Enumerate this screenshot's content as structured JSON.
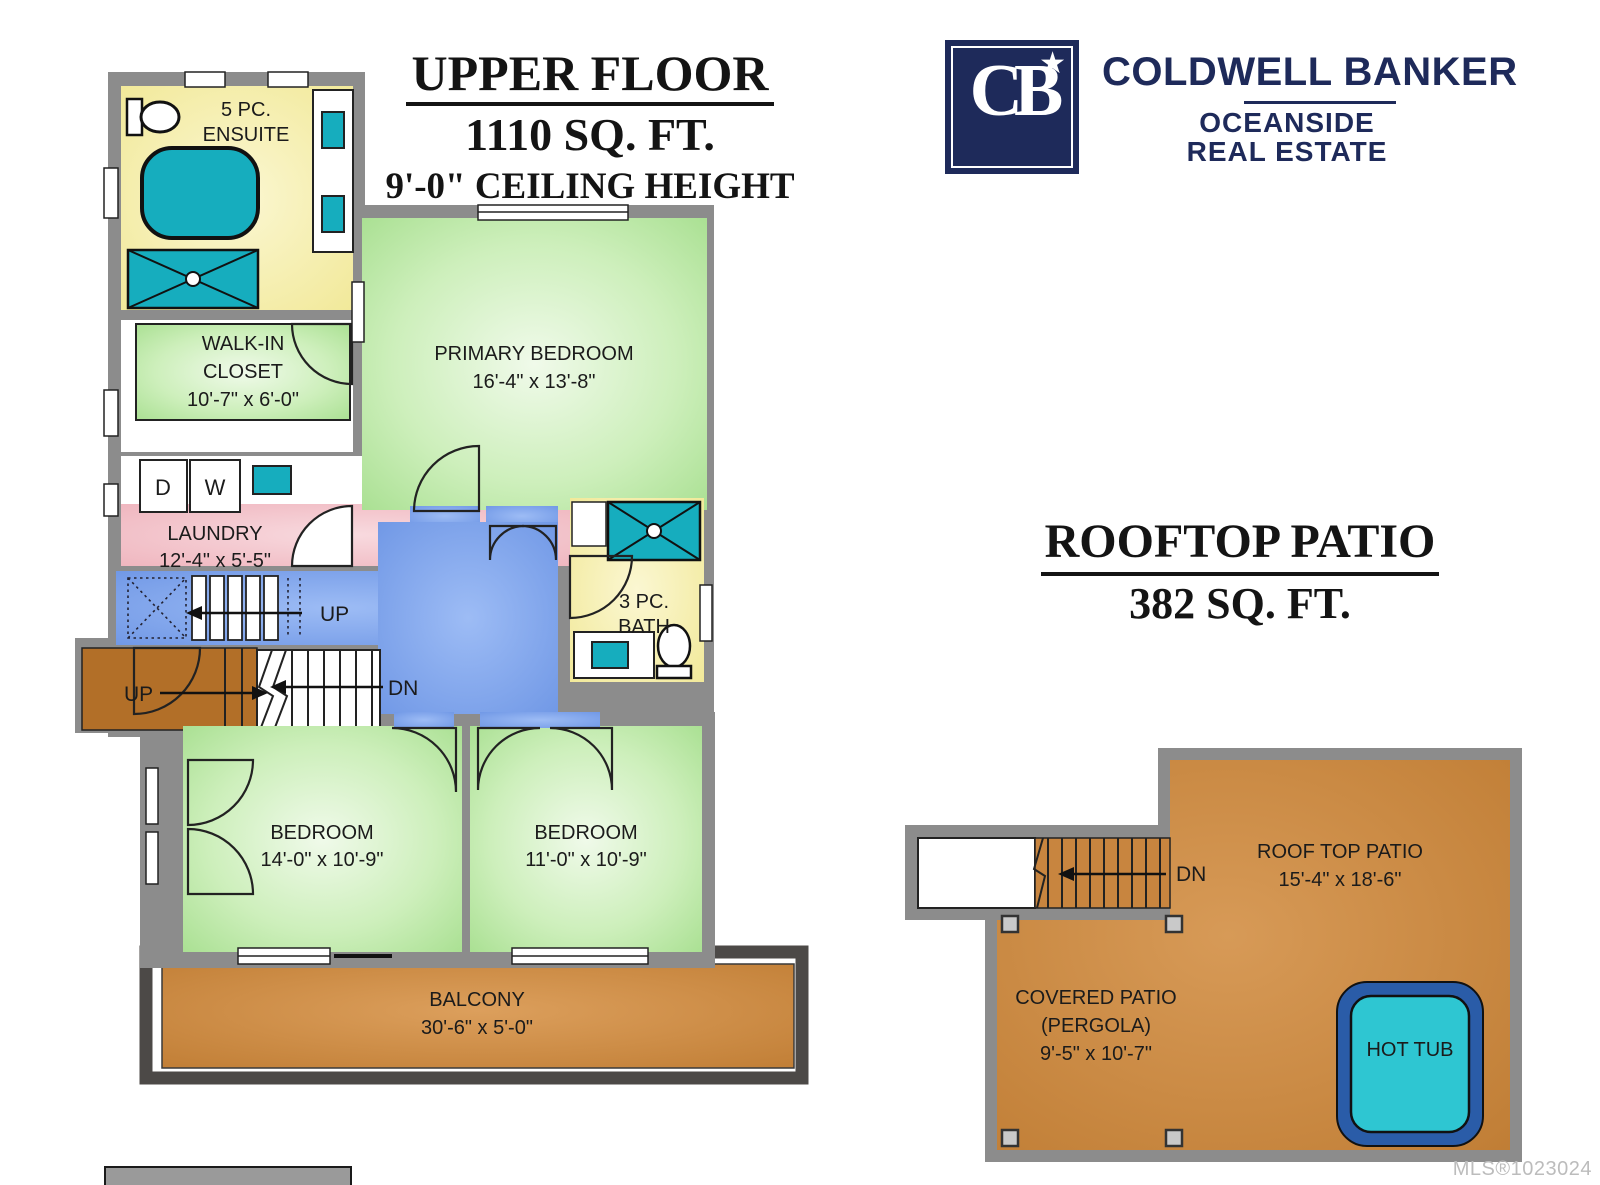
{
  "header": {
    "upper": {
      "title": "UPPER FLOOR",
      "area": "1110 SQ. FT.",
      "ceiling": "9'-0\" CEILING HEIGHT"
    },
    "brand": {
      "name": "COLDWELL BANKER",
      "sub1": "OCEANSIDE",
      "sub2": "REAL ESTATE",
      "monogram": "CB",
      "star": "★"
    }
  },
  "rooftop_header": {
    "title": "ROOFTOP PATIO",
    "area": "382 SQ. FT."
  },
  "rooms": {
    "ensuite": {
      "line1": "5 PC.",
      "line2": "ENSUITE"
    },
    "walkin": {
      "line1": "WALK-IN",
      "line2": "CLOSET",
      "dim": "10'-7\" x 6'-0\""
    },
    "laundry": {
      "name": "LAUNDRY",
      "dim": "12'-4\" x 5'-5\"",
      "dryer": "D",
      "washer": "W"
    },
    "primary": {
      "name": "PRIMARY BEDROOM",
      "dim": "16'-4\" x 13'-8\""
    },
    "bath": {
      "line1": "3 PC.",
      "line2": "BATH"
    },
    "bedroom1": {
      "name": "BEDROOM",
      "dim": "14'-0\" x 10'-9\""
    },
    "bedroom2": {
      "name": "BEDROOM",
      "dim": "11'-0\" x 10'-9\""
    },
    "balcony": {
      "name": "BALCONY",
      "dim": "30'-6\" x 5'-0\""
    },
    "stairs": {
      "up_corridor": "UP",
      "up_landing": "UP",
      "dn": "DN"
    }
  },
  "rooftop": {
    "patio": {
      "name": "ROOF TOP PATIO",
      "dim": "15'-4\" x 18'-6\""
    },
    "covered": {
      "line1": "COVERED PATIO",
      "line2": "(PERGOLA)",
      "dim": "9'-5\" x 10'-7\""
    },
    "hottub": {
      "name": "HOT TUB"
    },
    "dn": "DN"
  },
  "footer": {
    "mls": "MLS®1023024"
  },
  "colors": {
    "wall": "#8C8C8C",
    "navy": "#1E2A5A",
    "teal": "#16ADBE",
    "green_edge": "#A5DE8D",
    "yellow_edge": "#F1E896",
    "blue_edge": "#6E96E5",
    "pink_edge": "#EFB4BD",
    "deck_edge": "#BF7C33",
    "landing": "#B26F28",
    "hottub_ring": "#2A5CA8",
    "hottub_water": "#2EC6D2",
    "balcony_frame": "#4C4947"
  }
}
